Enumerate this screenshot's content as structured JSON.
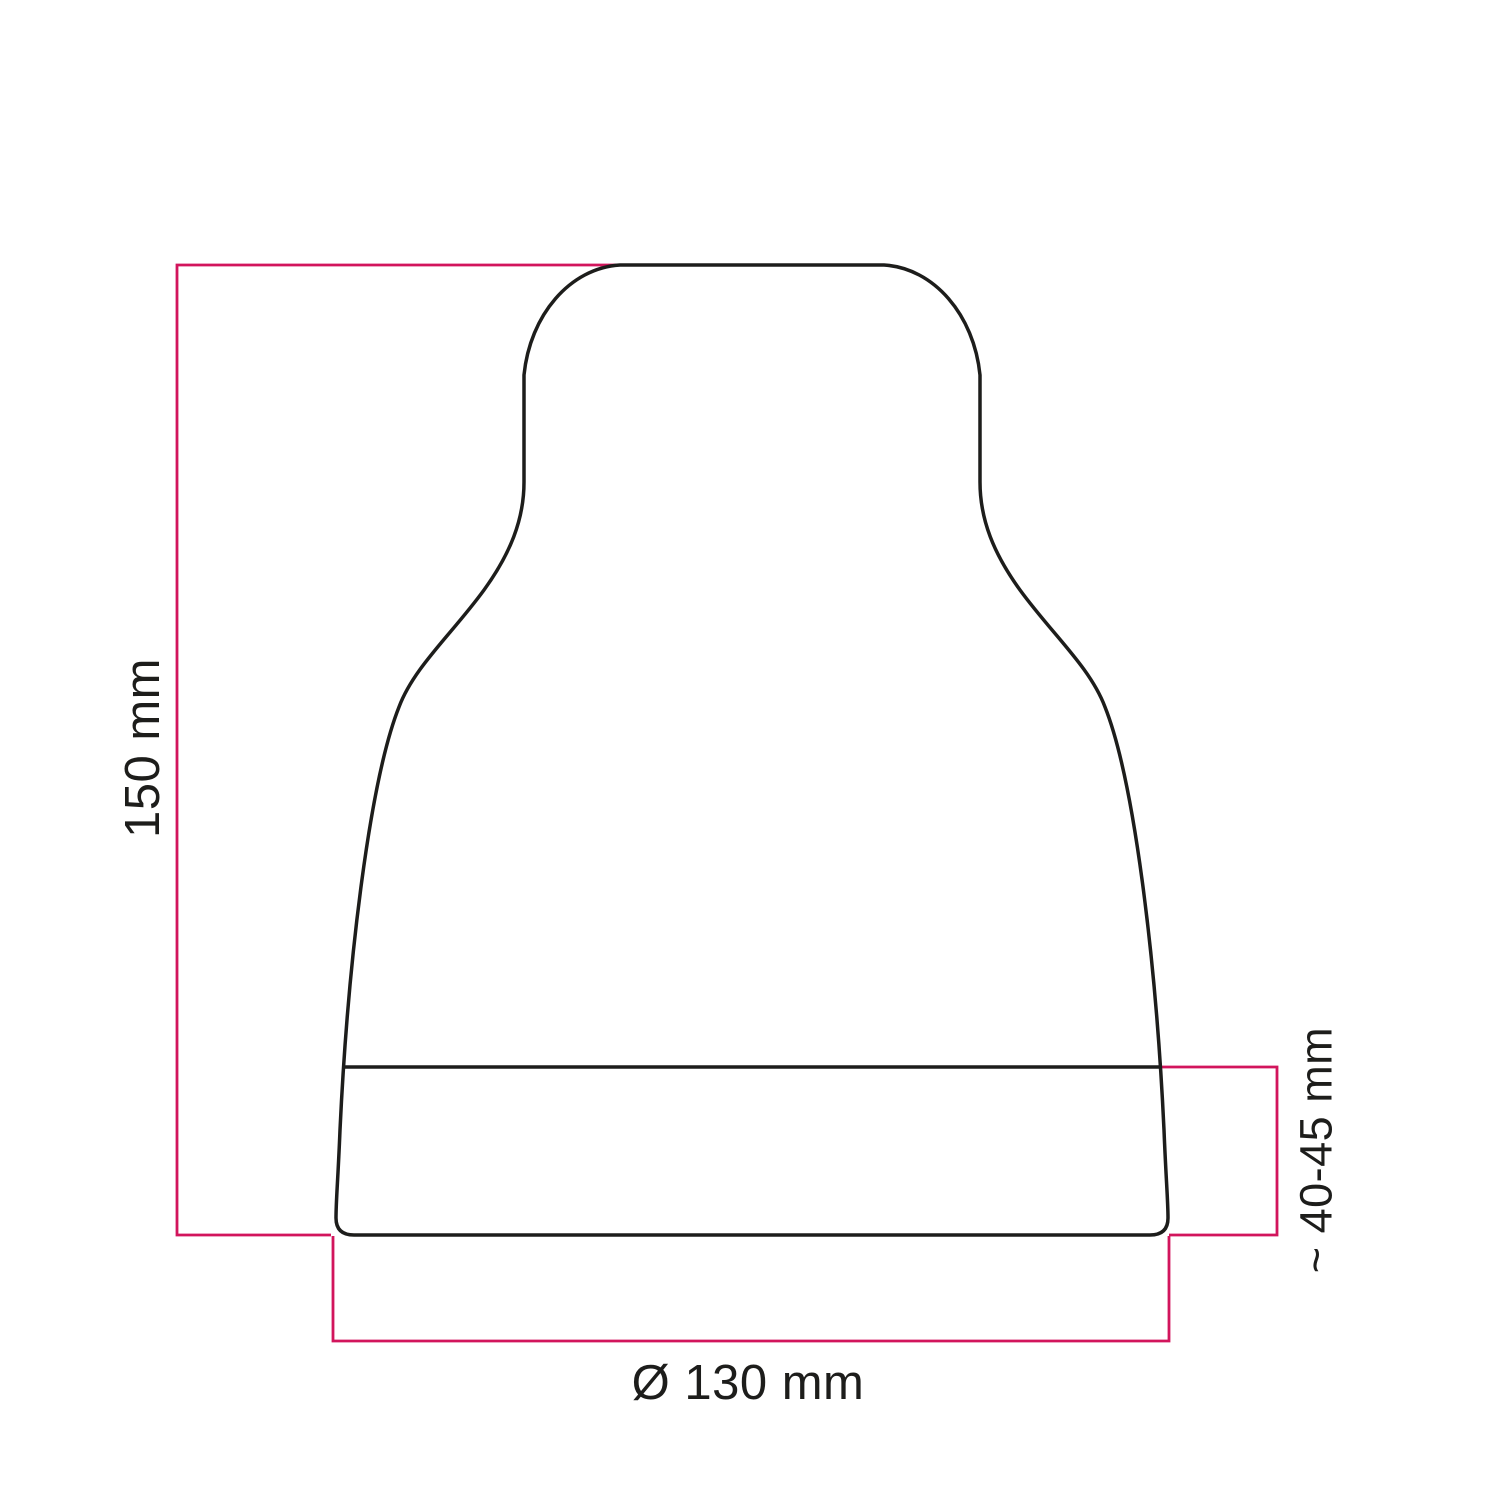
{
  "drawing": {
    "name": "lampshade-dimension-drawing",
    "dimensions": {
      "height": {
        "label": "150 mm"
      },
      "base_height": {
        "label": "~ 40-45 mm"
      },
      "diameter": {
        "label": "Ø 130 mm"
      }
    },
    "colors": {
      "outline": "#1d1d1b",
      "dimension": "#d2155c",
      "text": "#1d1d1b",
      "background": "#ffffff"
    }
  }
}
